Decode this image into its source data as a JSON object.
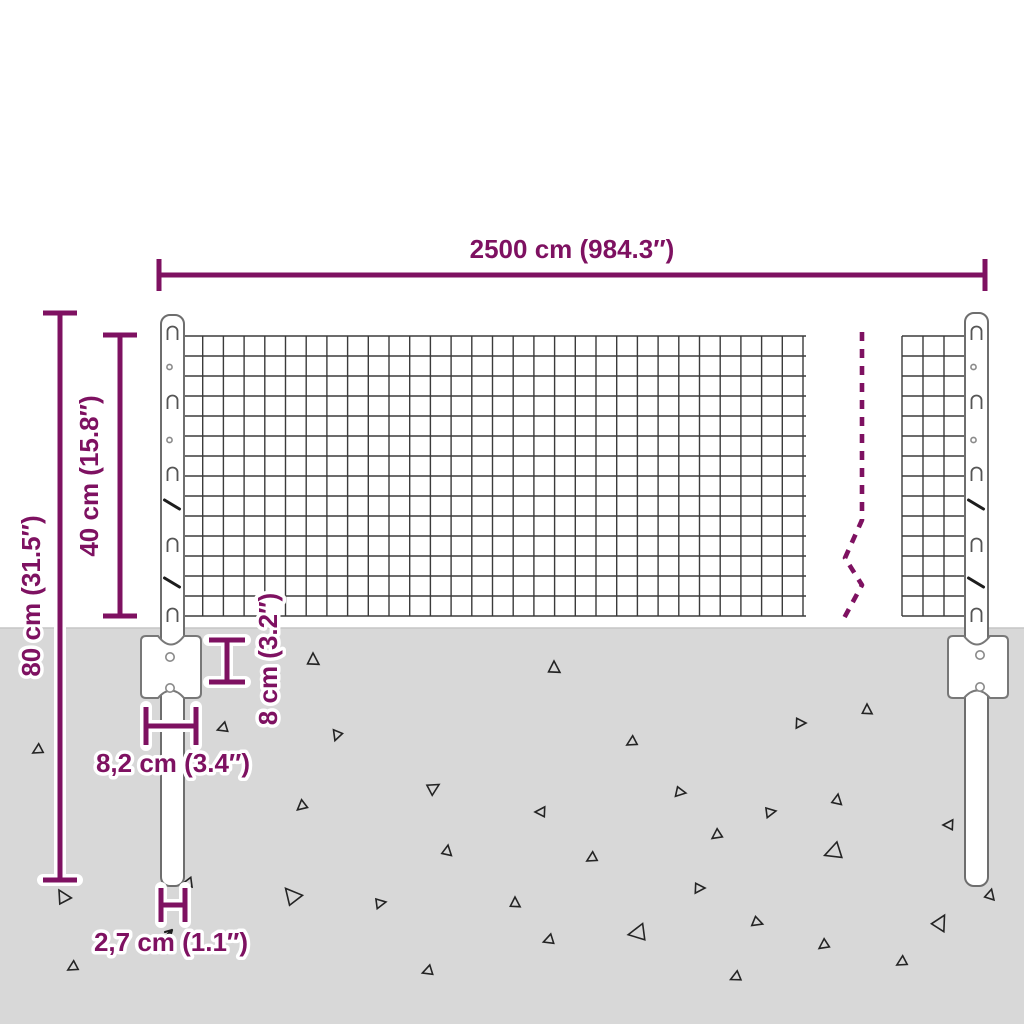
{
  "diagram": {
    "type": "product-dimension-diagram",
    "subject": "wire mesh fence panel with posts and ground anchor plates"
  },
  "colors": {
    "dimension_accent": "#7e1161",
    "ground": "#d8d8d8",
    "mesh_wire": "#3b3b3b",
    "post_outline": "#6e6e6e"
  },
  "labels": {
    "total_width": "2500 cm (984.3″)",
    "total_height": "80 cm (31.5″)",
    "mesh_height": "40 cm (15.8″)",
    "plate_height": "8 cm (3.2″)",
    "plate_width": "8,2 cm (3.4″)",
    "post_diameter": "2,7 cm (1.1″)"
  },
  "decor": {
    "triangles": [
      {
        "x": 313,
        "y": 660,
        "s": 7,
        "r": 0
      },
      {
        "x": 337,
        "y": 735,
        "s": 6,
        "r": 200
      },
      {
        "x": 223,
        "y": 728,
        "s": 6,
        "r": 250
      },
      {
        "x": 38,
        "y": 750,
        "s": 6,
        "r": 240
      },
      {
        "x": 433,
        "y": 788,
        "s": 7,
        "r": 60
      },
      {
        "x": 302,
        "y": 806,
        "s": 6,
        "r": 230
      },
      {
        "x": 447,
        "y": 851,
        "s": 6,
        "r": 10
      },
      {
        "x": 188,
        "y": 883,
        "s": 6,
        "r": 260
      },
      {
        "x": 63,
        "y": 897,
        "s": 8,
        "r": 330
      },
      {
        "x": 292,
        "y": 896,
        "s": 10,
        "r": 320
      },
      {
        "x": 380,
        "y": 903,
        "s": 6,
        "r": 80
      },
      {
        "x": 73,
        "y": 967,
        "s": 6,
        "r": 240
      },
      {
        "x": 428,
        "y": 971,
        "s": 6,
        "r": 250
      },
      {
        "x": 554,
        "y": 668,
        "s": 7,
        "r": 0
      },
      {
        "x": 632,
        "y": 742,
        "s": 6,
        "r": 240
      },
      {
        "x": 800,
        "y": 723,
        "s": 6,
        "r": 90
      },
      {
        "x": 867,
        "y": 710,
        "s": 6,
        "r": 0
      },
      {
        "x": 680,
        "y": 792,
        "s": 6,
        "r": 100
      },
      {
        "x": 541,
        "y": 812,
        "s": 6,
        "r": 270
      },
      {
        "x": 770,
        "y": 812,
        "s": 6,
        "r": 80
      },
      {
        "x": 837,
        "y": 800,
        "s": 6,
        "r": 10
      },
      {
        "x": 717,
        "y": 835,
        "s": 6,
        "r": 235
      },
      {
        "x": 949,
        "y": 825,
        "s": 6,
        "r": 270
      },
      {
        "x": 592,
        "y": 858,
        "s": 6,
        "r": 240
      },
      {
        "x": 834,
        "y": 852,
        "s": 10,
        "r": 250
      },
      {
        "x": 699,
        "y": 888,
        "s": 6,
        "r": 90
      },
      {
        "x": 515,
        "y": 903,
        "s": 6,
        "r": 0
      },
      {
        "x": 757,
        "y": 922,
        "s": 6,
        "r": 110
      },
      {
        "x": 638,
        "y": 933,
        "s": 10,
        "r": 260
      },
      {
        "x": 549,
        "y": 940,
        "s": 6,
        "r": 250
      },
      {
        "x": 824,
        "y": 945,
        "s": 6,
        "r": 235
      },
      {
        "x": 940,
        "y": 923,
        "s": 9,
        "r": 30
      },
      {
        "x": 990,
        "y": 895,
        "s": 6,
        "r": 15
      },
      {
        "x": 902,
        "y": 962,
        "s": 6,
        "r": 240
      },
      {
        "x": 736,
        "y": 977,
        "s": 6,
        "r": 245
      }
    ]
  }
}
